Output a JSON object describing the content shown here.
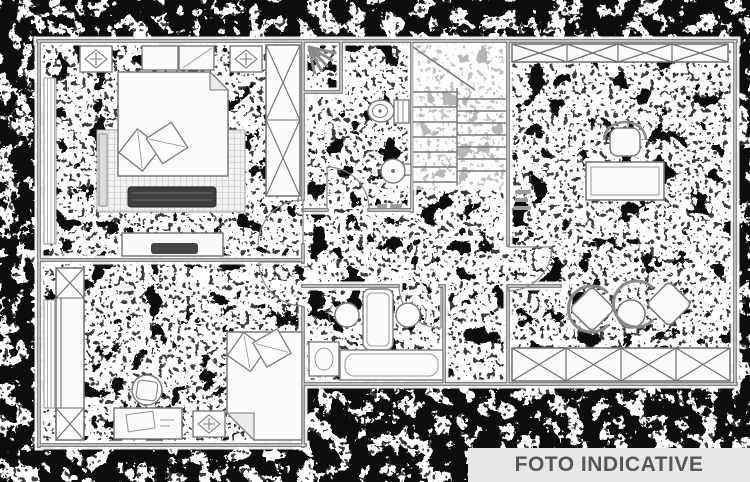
{
  "banner": {
    "label": "FOTO INDICATIVE"
  },
  "image": {
    "kind": "black-and-white floor plan photo, heavily dithered/noisy scan",
    "visible_text": [
      "FOTO INDICATIVE"
    ]
  },
  "colors": {
    "paper": "#ffffff",
    "noise": "#0d0d0d",
    "wall_line": "#5f5f5f",
    "furniture_line": "#787878",
    "banner_bg": "#e7e7e7",
    "banner_text": "#575757",
    "dark_furniture": "#3f3f3f"
  }
}
